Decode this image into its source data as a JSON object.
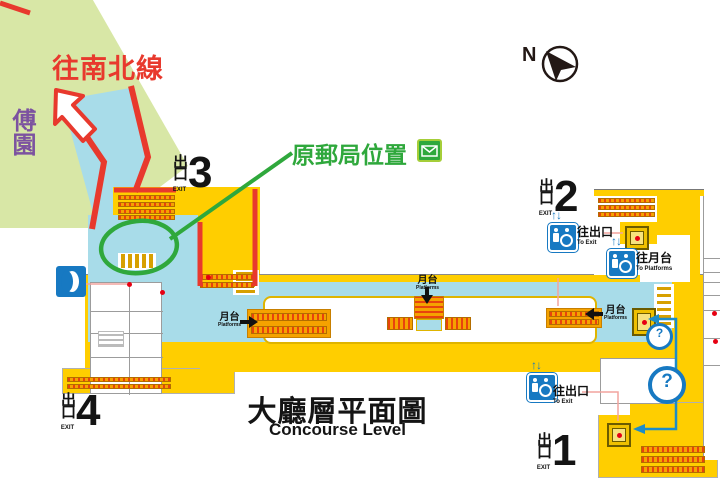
{
  "palette": {
    "yellow": "#FFCE00",
    "orange": "#F5A200",
    "stripe": "#E8430D",
    "bluearea": "#A8DCE9",
    "park": "#D8E7A6",
    "red": "#E8392D",
    "green": "#2FA83C",
    "blueicon": "#1779C2",
    "purple": "#7C52A0",
    "pink": "#F2A49E",
    "dark": "#231815",
    "dot": "#E60012"
  },
  "annotations": {
    "to_ns_line": "往南北線",
    "fu_garden": "傅園",
    "post_office": "原郵局位置"
  },
  "compass": {
    "north": "N"
  },
  "title": {
    "zh": "大廳層平面圖",
    "en": "Concourse Level"
  },
  "exits": {
    "e1": {
      "zh": "出口",
      "en": "EXIT",
      "num": "1"
    },
    "e2": {
      "zh": "出口",
      "en": "EXIT",
      "num": "2"
    },
    "e3": {
      "zh": "出口",
      "en": "EXIT",
      "num": "3"
    },
    "e4": {
      "zh": "出口",
      "en": "EXIT",
      "num": "4"
    }
  },
  "platform": {
    "zh": "月台",
    "en": "Platforms"
  },
  "lifts": {
    "arrows": "↑↓",
    "to_exit_zh": "往出口",
    "to_exit_en": "To Exit",
    "to_platform_zh": "往月台",
    "to_platform_en": "To Platforms"
  },
  "info": {
    "question": "?"
  }
}
